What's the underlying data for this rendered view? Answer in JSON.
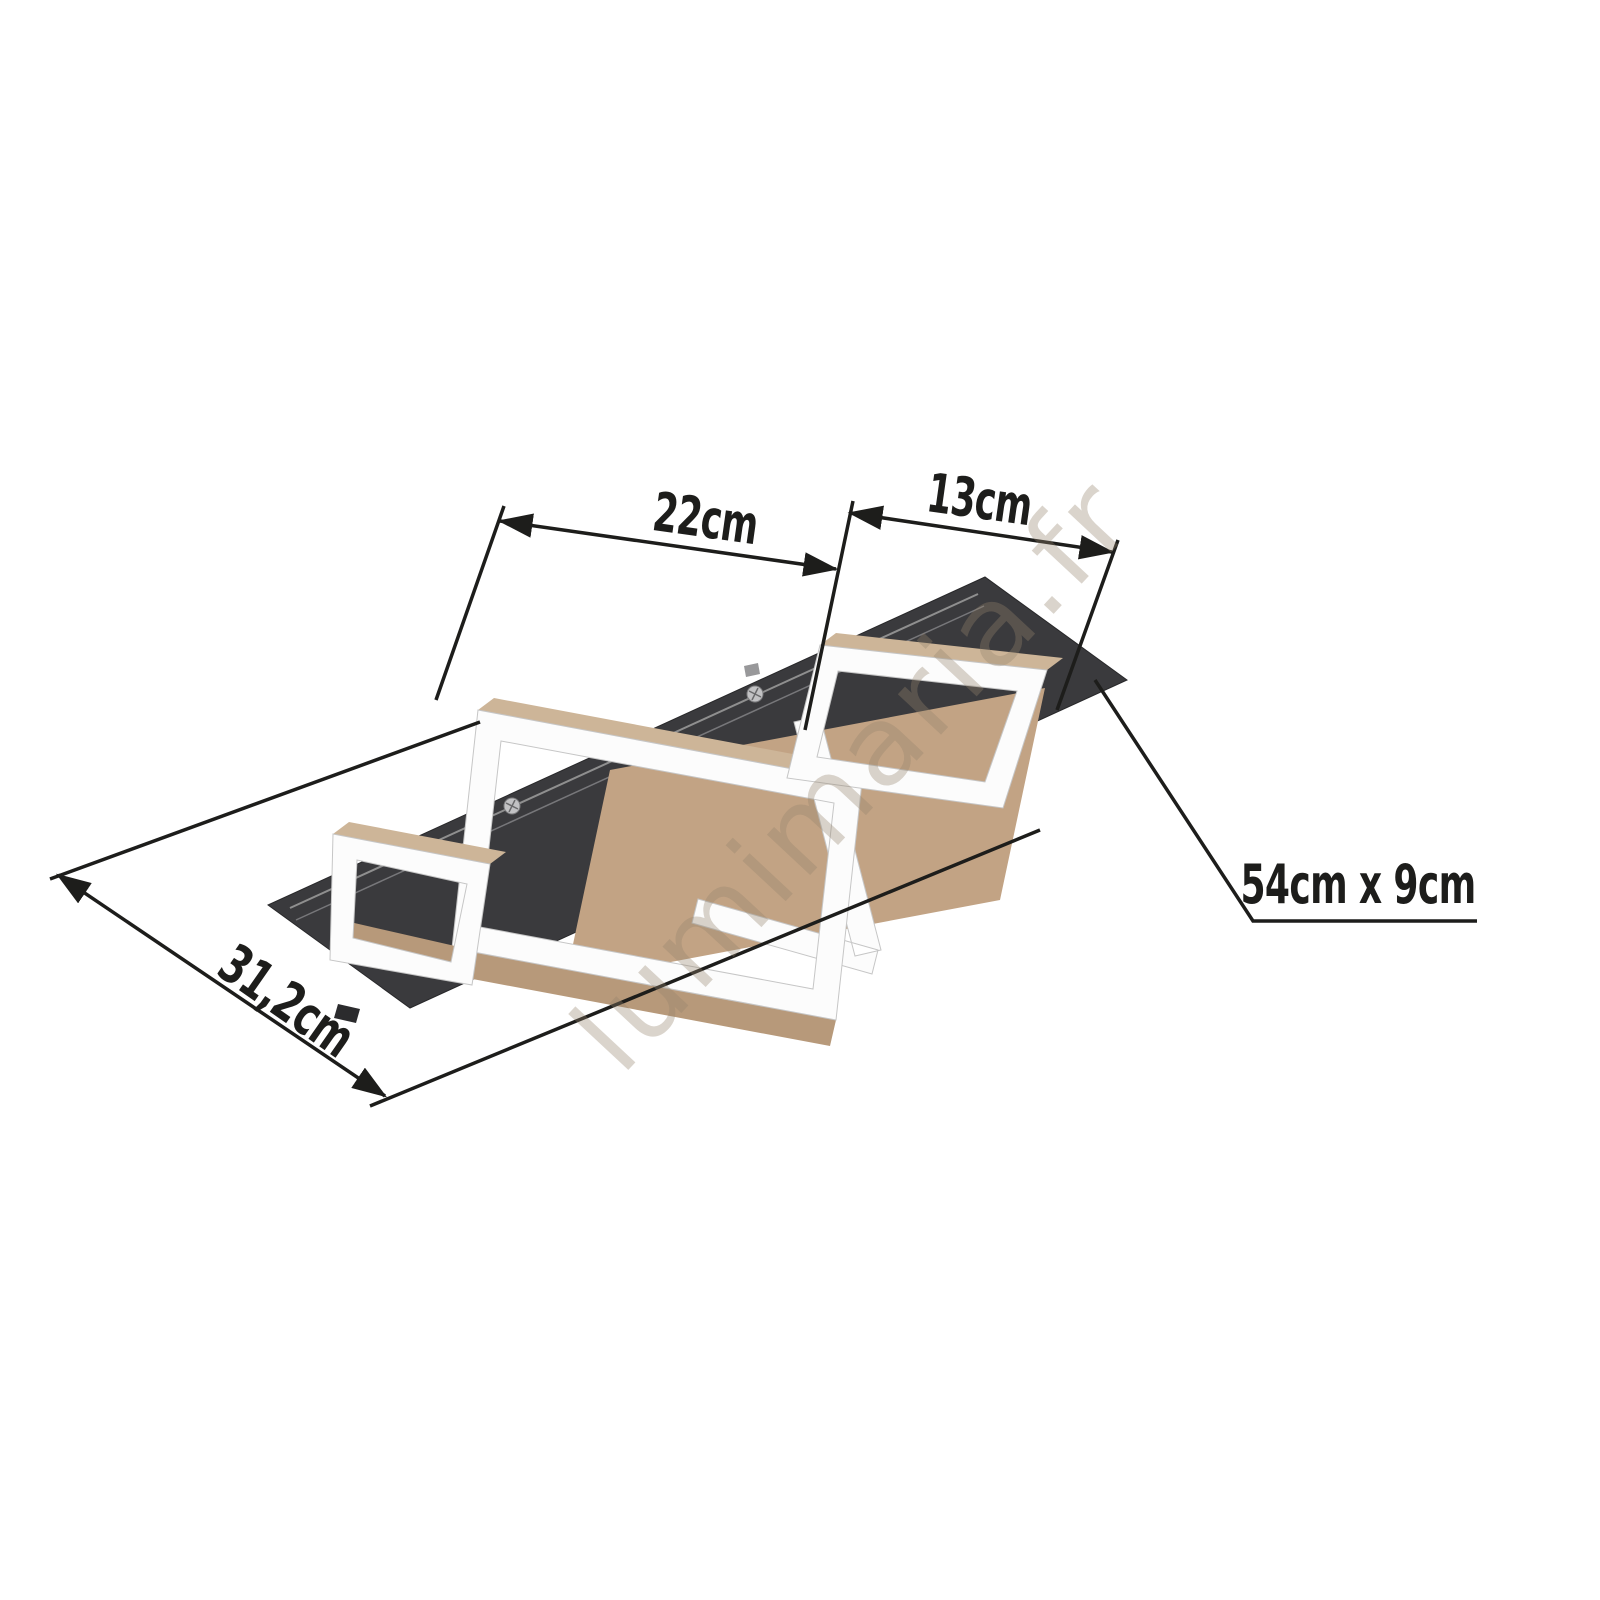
{
  "watermark": {
    "text": "lumimaria.fr"
  },
  "dimension_labels": {
    "inner_width": "22cm",
    "right_width": "13cm",
    "depth": "31,2cm",
    "plate": "54cm x 9cm"
  },
  "product": {
    "parts": [
      "mounting-plate",
      "left-led-frame",
      "long-led-frame",
      "right-led-frame",
      "wood-panel"
    ]
  },
  "colors": {
    "background": "#ffffff",
    "plate_black": "#3a3a3d",
    "wood_tan": "#cdb598",
    "wood_tan_deep": "#b7997a",
    "frame_white": "#fcfcfc",
    "dimension_ink": "#1d1d1b"
  }
}
